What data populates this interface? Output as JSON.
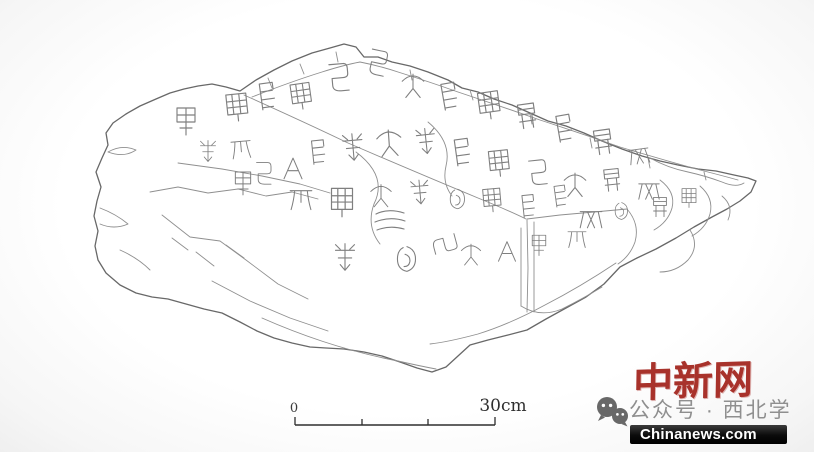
{
  "figure": {
    "description": "Archaeological line-drawing tracing of an irregular inscribed stone slab bearing columns of ancient Chinese seal-script characters and natural fracture lines",
    "stroke_color": "#7a7a7a",
    "background": "#ffffff"
  },
  "scale_bar": {
    "start_label": "0",
    "end_label": "30cm",
    "units": "cm",
    "total_cm": 30,
    "segments": 3
  },
  "branding": {
    "logo_text": "中新网",
    "logo_color": "#a8322b",
    "banner_text": "Chinanews.com",
    "banner_bg": "#141414",
    "banner_text_color": "#ffffff"
  },
  "watermark": {
    "wechat_text": "公众号 · 西北学",
    "wechat_text_color": "#8f8f8f",
    "icon": "wechat-icon"
  }
}
